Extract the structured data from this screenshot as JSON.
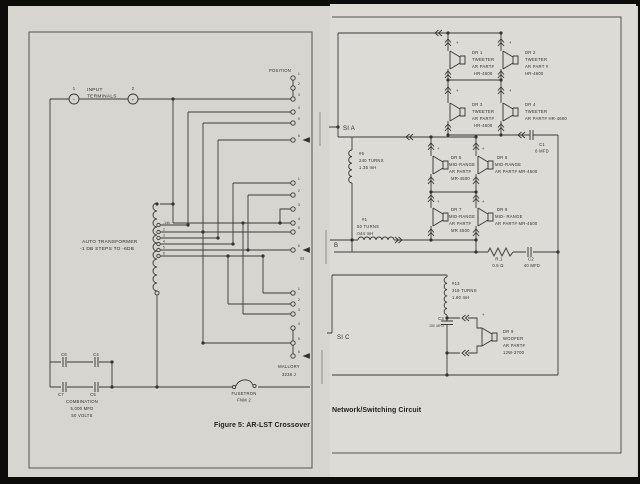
{
  "left": {
    "caption": "Figure 5: AR-LST Crossover",
    "input": {
      "line1": "INPUT",
      "line2": "TERMINALS",
      "n1": "1",
      "n2": "2",
      "minus": "−",
      "plus": "+"
    },
    "position_label": "POSITION",
    "transformer": {
      "line1": "AUTO TRANSFORMER",
      "line2": "-1 DB STEPS TO -6DB",
      "taps": [
        "-1db",
        "2",
        "3",
        "4",
        "5",
        "6"
      ]
    },
    "contact_numbers": [
      "1",
      "2",
      "3",
      "4",
      "5",
      "6"
    ],
    "si_label": "SI",
    "mallory": {
      "line1": "MALLORY",
      "line2": "3236 J"
    },
    "fuse": {
      "line1": "FUSETRON",
      "line2": "FNM 2"
    },
    "capacitors": {
      "c6": "C6",
      "c4": "C4",
      "c7": "C7",
      "c5": "C5",
      "combo1": "COMBINATION",
      "combo2": "5,000 MFD",
      "combo3": "50 VOLTS"
    }
  },
  "right": {
    "caption": "Network/Switching Circuit",
    "nodes": {
      "si_a": "SI A",
      "b": "B",
      "si_c": "SI C"
    },
    "plus": "+",
    "coils": {
      "coil6": [
        "#6",
        "240 TURNS",
        "1.35 mH"
      ],
      "coil1": [
        "#1",
        "50 TURNS",
        ".044 mH"
      ],
      "coil13": [
        "#13",
        "316 TURNS",
        "1.60 mH"
      ]
    },
    "components": {
      "c1": [
        "C1",
        "6 MFD"
      ],
      "r1": [
        "R.1",
        "0.5 Ω"
      ],
      "c2": [
        "C2",
        "40 MFD"
      ],
      "c3": [
        "C3",
        "150 MFD"
      ]
    },
    "drivers": {
      "dr1": [
        "DR 1",
        "TWEETER",
        "AR PART#",
        "HR-4600"
      ],
      "dr2": [
        "DR 2",
        "TWEETER",
        "AR PART #",
        "HR-4600"
      ],
      "dr3": [
        "DR 3",
        "TWEETER",
        "AR PART#",
        "HR-4600"
      ],
      "dr4": [
        "DR 4",
        "TWEETER",
        "AR PART# HR-4600"
      ],
      "dr5": [
        "DR 5",
        "MID-RANGE",
        "AR PART#",
        "MR-4500"
      ],
      "dr6": [
        "DR 6",
        "MID-RANGE",
        "AR PART# MR-4500"
      ],
      "dr7": [
        "DR 7",
        "MID-RANGE",
        "AR PART#",
        "MR 4500"
      ],
      "dr8": [
        "DR 8",
        "MID- RANGE",
        "AR PART# MR-4500"
      ],
      "dr9": [
        "DR 9",
        "WOOFER",
        "AR PART#",
        "12W-3700"
      ]
    }
  }
}
